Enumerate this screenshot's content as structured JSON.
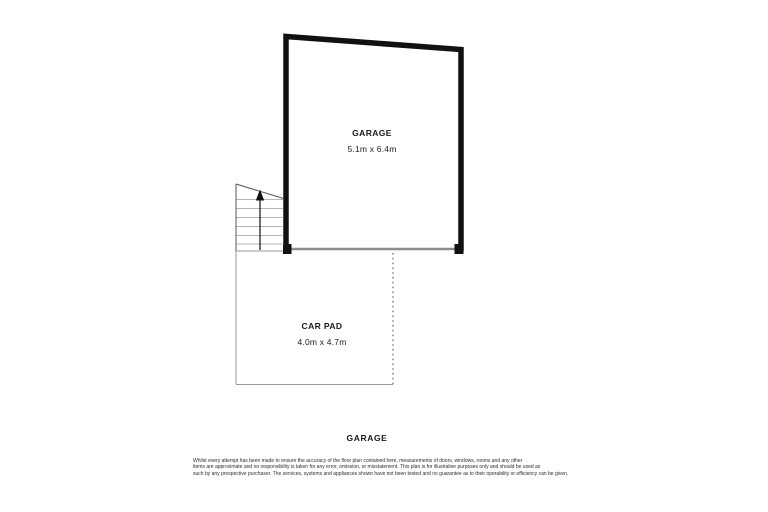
{
  "floor_plan": {
    "rooms": {
      "garage": {
        "label": "GARAGE",
        "dimensions": "5.1m x 6.4m"
      },
      "car_pad": {
        "label": "CAR PAD",
        "dimensions": "4.0m x 4.7m"
      }
    },
    "stairs": {
      "direction": "up"
    },
    "footer_label": "GARAGE",
    "disclaimer": {
      "lines": [
        "Whilst every attempt has been made to ensure the accuracy of the floor plan contained here, measurements of doors, windows, rooms and any other",
        "items are approximate and no responsibility is taken for any error, omission, or misstatement. This plan is for illustrative purposes only and should be used as",
        "such by any prospective purchaser. The services, systems and appliances shown have not been tested and no guarantee as to their operability or efficiency can be given."
      ]
    },
    "colors": {
      "wall": "#111111",
      "door_opening": "#8c8c8c",
      "outline_thin": "#999999",
      "step_line": "#b5b5b5",
      "stair_edge": "#555555",
      "arrow": "#111111"
    }
  }
}
